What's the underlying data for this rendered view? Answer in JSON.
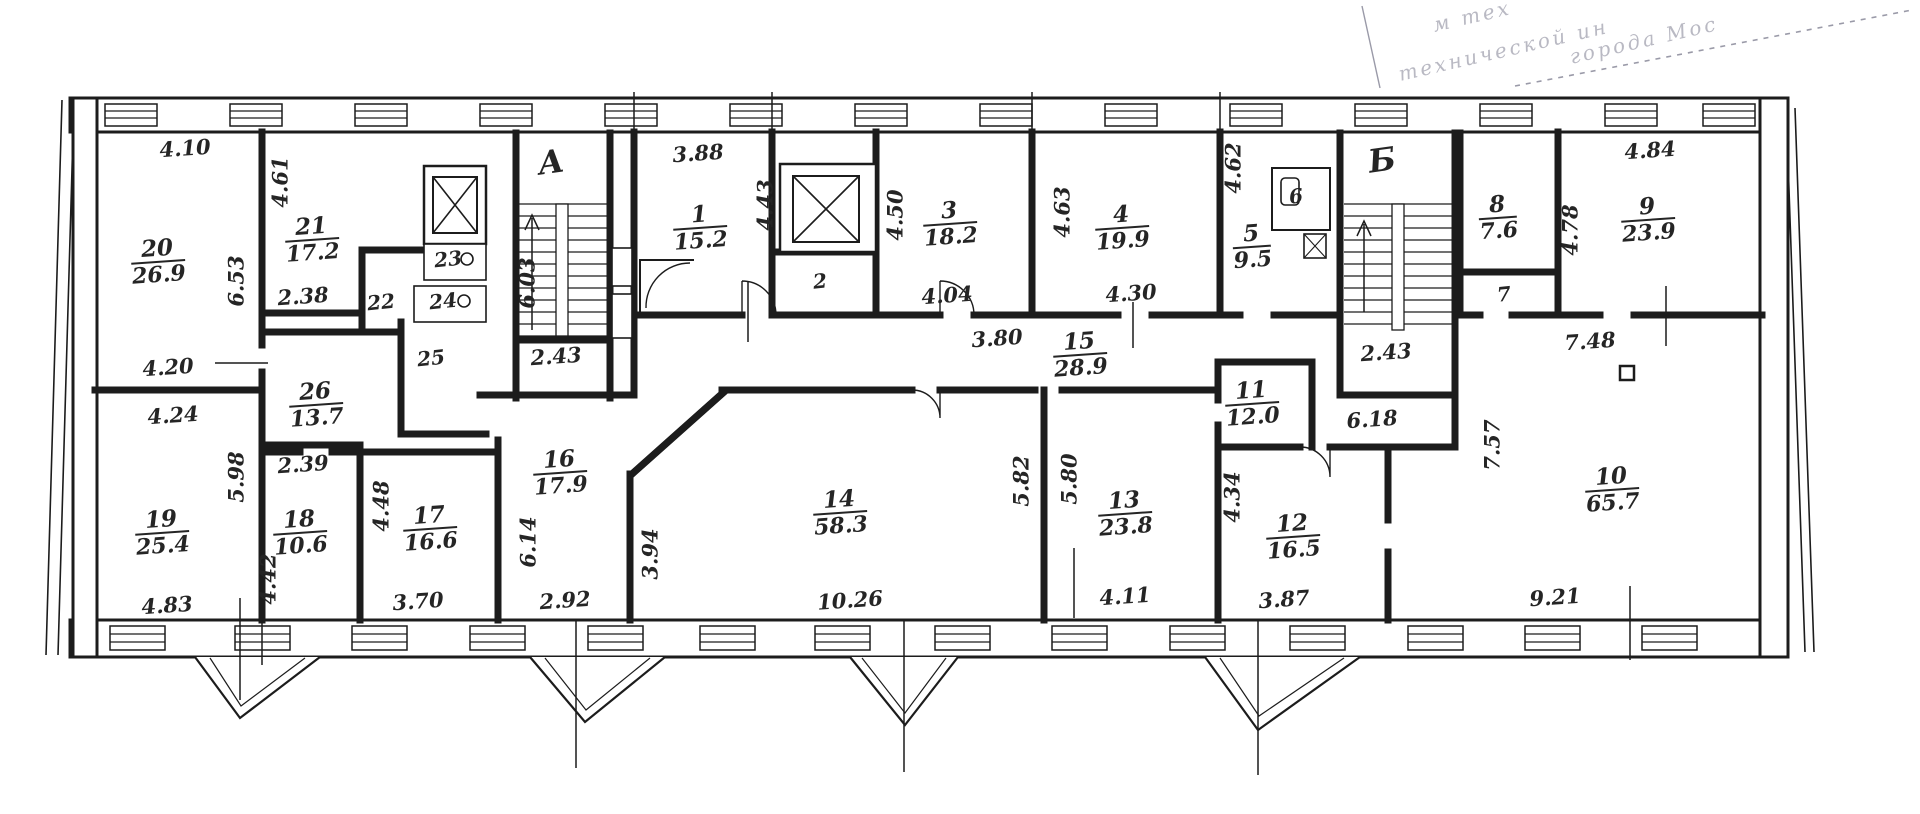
{
  "stamp": {
    "line1": "м тех",
    "line2": "технической ин",
    "line3": "города Мос"
  },
  "staircases": {
    "a": "А",
    "b": "Б"
  },
  "rooms": {
    "r1": {
      "num": "1",
      "area": "15.2"
    },
    "r3": {
      "num": "3",
      "area": "18.2"
    },
    "r4": {
      "num": "4",
      "area": "19.9"
    },
    "r5": {
      "num": "5",
      "area": "9.5"
    },
    "r8": {
      "num": "8",
      "area": "7.6"
    },
    "r9": {
      "num": "9",
      "area": "23.9"
    },
    "r10": {
      "num": "10",
      "area": "65.7"
    },
    "r11": {
      "num": "11",
      "area": "12.0"
    },
    "r12": {
      "num": "12",
      "area": "16.5"
    },
    "r13": {
      "num": "13",
      "area": "23.8"
    },
    "r14": {
      "num": "14",
      "area": "58.3"
    },
    "r15": {
      "num": "15",
      "area": "28.9"
    },
    "r16": {
      "num": "16",
      "area": "17.9"
    },
    "r17": {
      "num": "17",
      "area": "16.6"
    },
    "r18": {
      "num": "18",
      "area": "10.6"
    },
    "r19": {
      "num": "19",
      "area": "25.4"
    },
    "r20": {
      "num": "20",
      "area": "26.9"
    },
    "r21": {
      "num": "21",
      "area": "17.2"
    },
    "r26": {
      "num": "26",
      "area": "13.7"
    }
  },
  "closets": {
    "c2": "2",
    "c6": "6",
    "c7": "7",
    "c22": "22",
    "c23": "23",
    "c24": "24",
    "c25": "25"
  },
  "dims": {
    "d410": "4.10",
    "d461": "4.61",
    "d653": "6.53",
    "d238": "2.38",
    "d420": "4.20",
    "d424": "4.24",
    "d598": "5.98",
    "d239": "2.39",
    "d483": "4.83",
    "d442": "4.42",
    "d448": "4.48",
    "d370": "3.70",
    "d614": "6.14",
    "d292": "2.92",
    "d394": "3.94",
    "d603": "6.03",
    "d243a": "2.43",
    "d388": "3.88",
    "d443": "4.43",
    "d450": "4.50",
    "d404": "4.04",
    "d380": "3.80",
    "d463": "4.63",
    "d430": "4.30",
    "d462": "4.62",
    "d582": "5.82",
    "d580": "5.80",
    "d1026": "10.26",
    "d411": "4.11",
    "d434": "4.34",
    "d387": "3.87",
    "d618": "6.18",
    "d243b": "2.43",
    "d748": "7.48",
    "d757": "7.57",
    "d484": "4.84",
    "d478": "4.78",
    "d921": "9.21"
  },
  "colors": {
    "ink": "#1c1c1c",
    "stamp": "#8a8a96"
  }
}
